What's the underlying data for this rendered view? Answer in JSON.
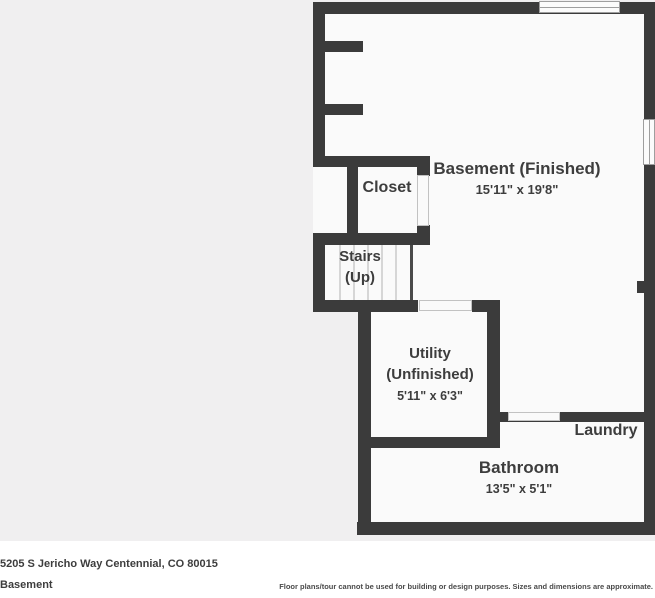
{
  "rooms": {
    "basement": {
      "label": "Basement (Finished)",
      "dims": "15'11\" x 19'8\""
    },
    "closet": {
      "label": "Closet"
    },
    "stairs": {
      "line1": "Stairs",
      "line2": "(Up)"
    },
    "utility": {
      "line1": "Utility",
      "line2": "(Unfinished)",
      "dims": "5'11\" x 6'3\""
    },
    "laundry": {
      "label": "Laundry"
    },
    "bathroom": {
      "label": "Bathroom",
      "dims": "13'5\" x 5'1\""
    }
  },
  "footer": {
    "address": "5205 S Jericho Way Centennial, CO 80015",
    "floor_label": "Basement",
    "disclaimer": "Floor plans/tour cannot be used for building or design purposes. Sizes and dimensions are approximate."
  },
  "colors": {
    "wall": "#3b3b3b",
    "interior": "#fafafa",
    "exterior_background": "#f0eff0",
    "footer_background": "#ffffff",
    "text": "#3d3d3d"
  }
}
